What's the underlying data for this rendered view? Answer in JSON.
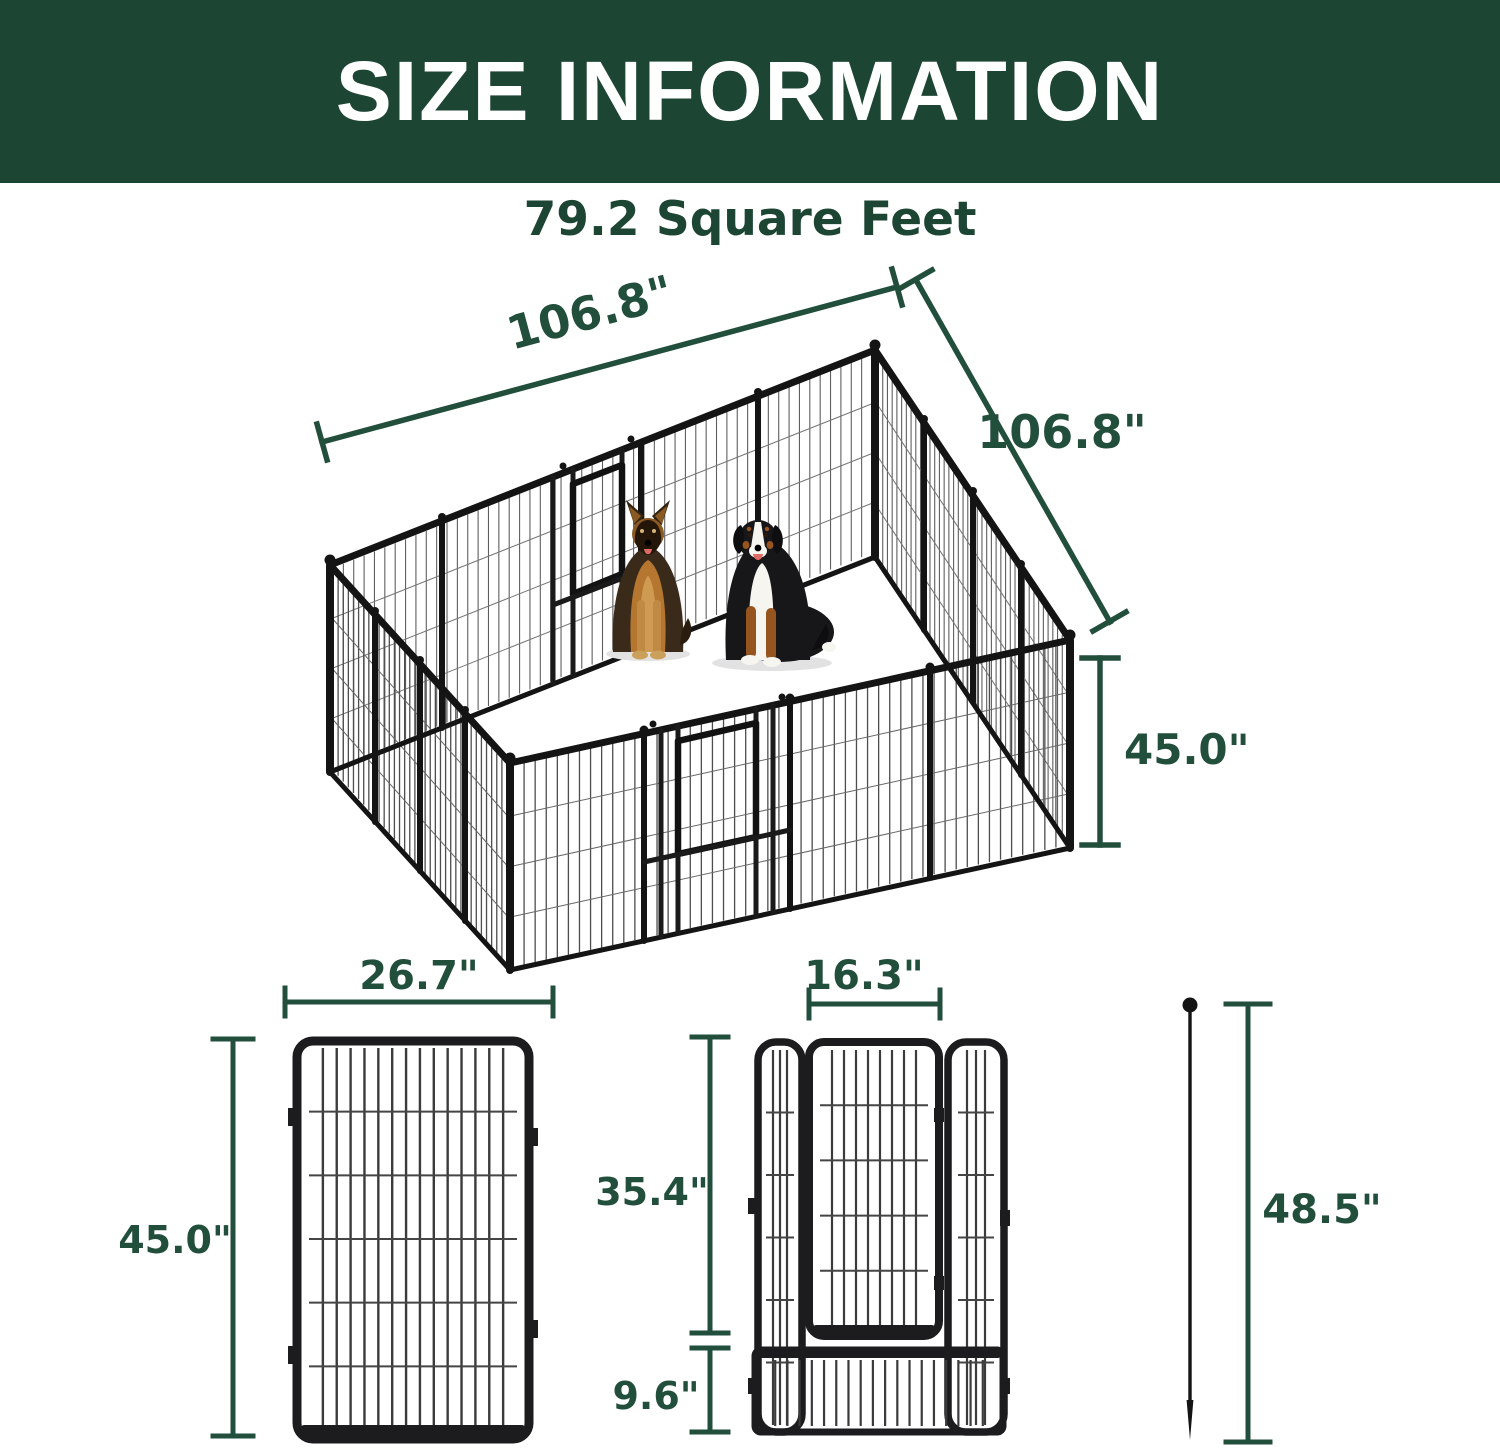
{
  "header": {
    "title": "SIZE INFORMATION"
  },
  "subtitle": "79.2 Square Feet",
  "overview": {
    "top_width_label": "106.8\"",
    "right_depth_label": "106.8\"",
    "height_label": "45.0\"",
    "illustrations": [
      "german-shepherd",
      "bernese-mountain-dog",
      "metal-playpen-16-panels-2-doors"
    ]
  },
  "panel_figure": {
    "width_label": "26.7\"",
    "height_label": "45.0\""
  },
  "door_figure": {
    "width_label": "16.3\"",
    "door_height_label": "35.4\"",
    "bottom_height_label": "9.6\""
  },
  "stake_figure": {
    "height_label": "48.5\""
  },
  "colors": {
    "header_green": "#1d4533",
    "dimension_green": "#224e3c",
    "pen_black": "#1c1c1e",
    "background": "#ffffff"
  }
}
